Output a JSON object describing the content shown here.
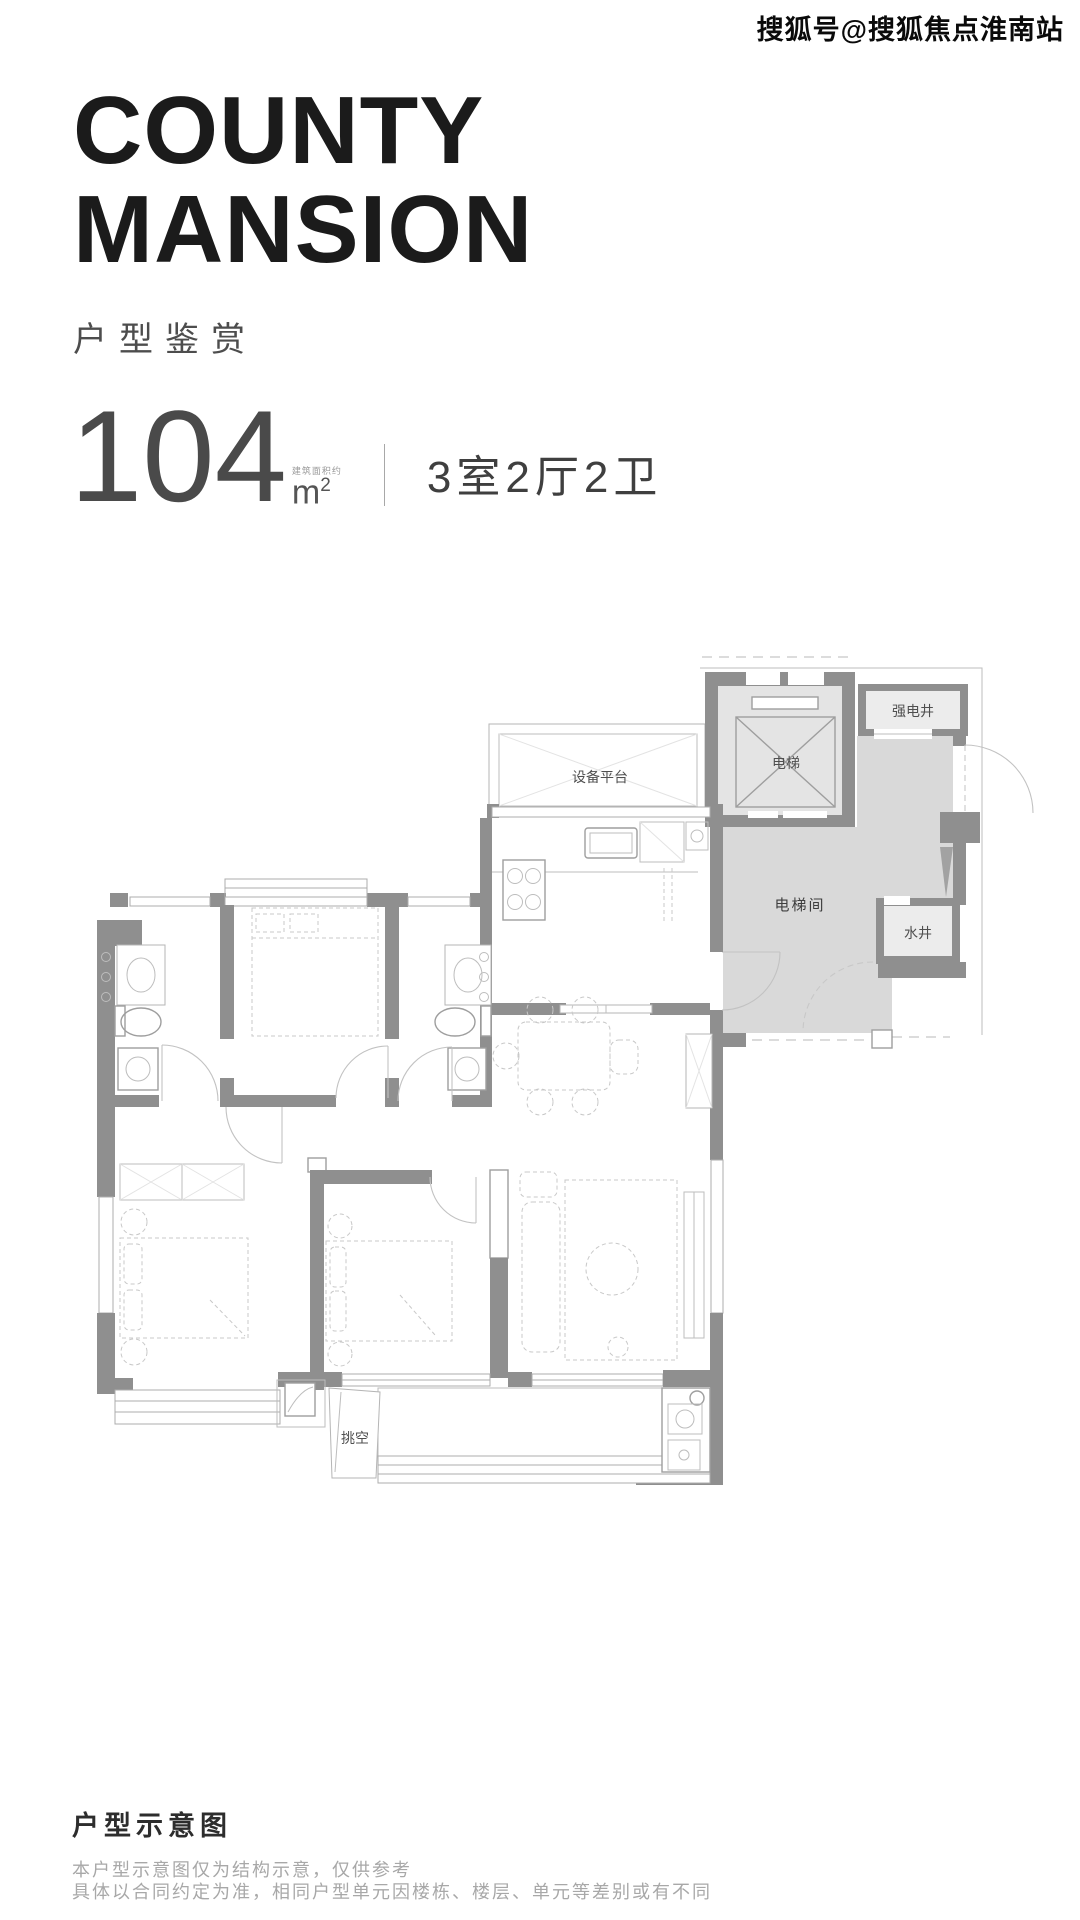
{
  "watermark": {
    "text": "搜狐号@搜狐焦点淮南站"
  },
  "header": {
    "title_line1": "COUNTY",
    "title_line2": "MANSION",
    "subtitle": "户型鉴赏"
  },
  "unit_info": {
    "area_value": "104",
    "area_note": "建筑面积约",
    "area_unit_base": "m",
    "area_unit_exp": "2",
    "rooms": "3室2厅2卫"
  },
  "floor_plan": {
    "labels": {
      "equipment_platform": "设备平台",
      "elevator": "电梯",
      "power_shaft": "强电井",
      "elevator_hall": "电梯间",
      "water_shaft": "水井",
      "void_space": "挑空"
    }
  },
  "footer": {
    "heading": "户型示意图",
    "disclaimers": [
      "本户型示意图仅为结构示意，仅供参考",
      "具体以合同约定为准，相同户型单元因楼栋、楼层、单元等差别或有不同"
    ]
  },
  "colors": {
    "wall": "#8f8f8f",
    "lobby_fill": "#d9d9d9",
    "shaft_fill": "#e4e4e4",
    "title_text": "#1b1b1b"
  }
}
